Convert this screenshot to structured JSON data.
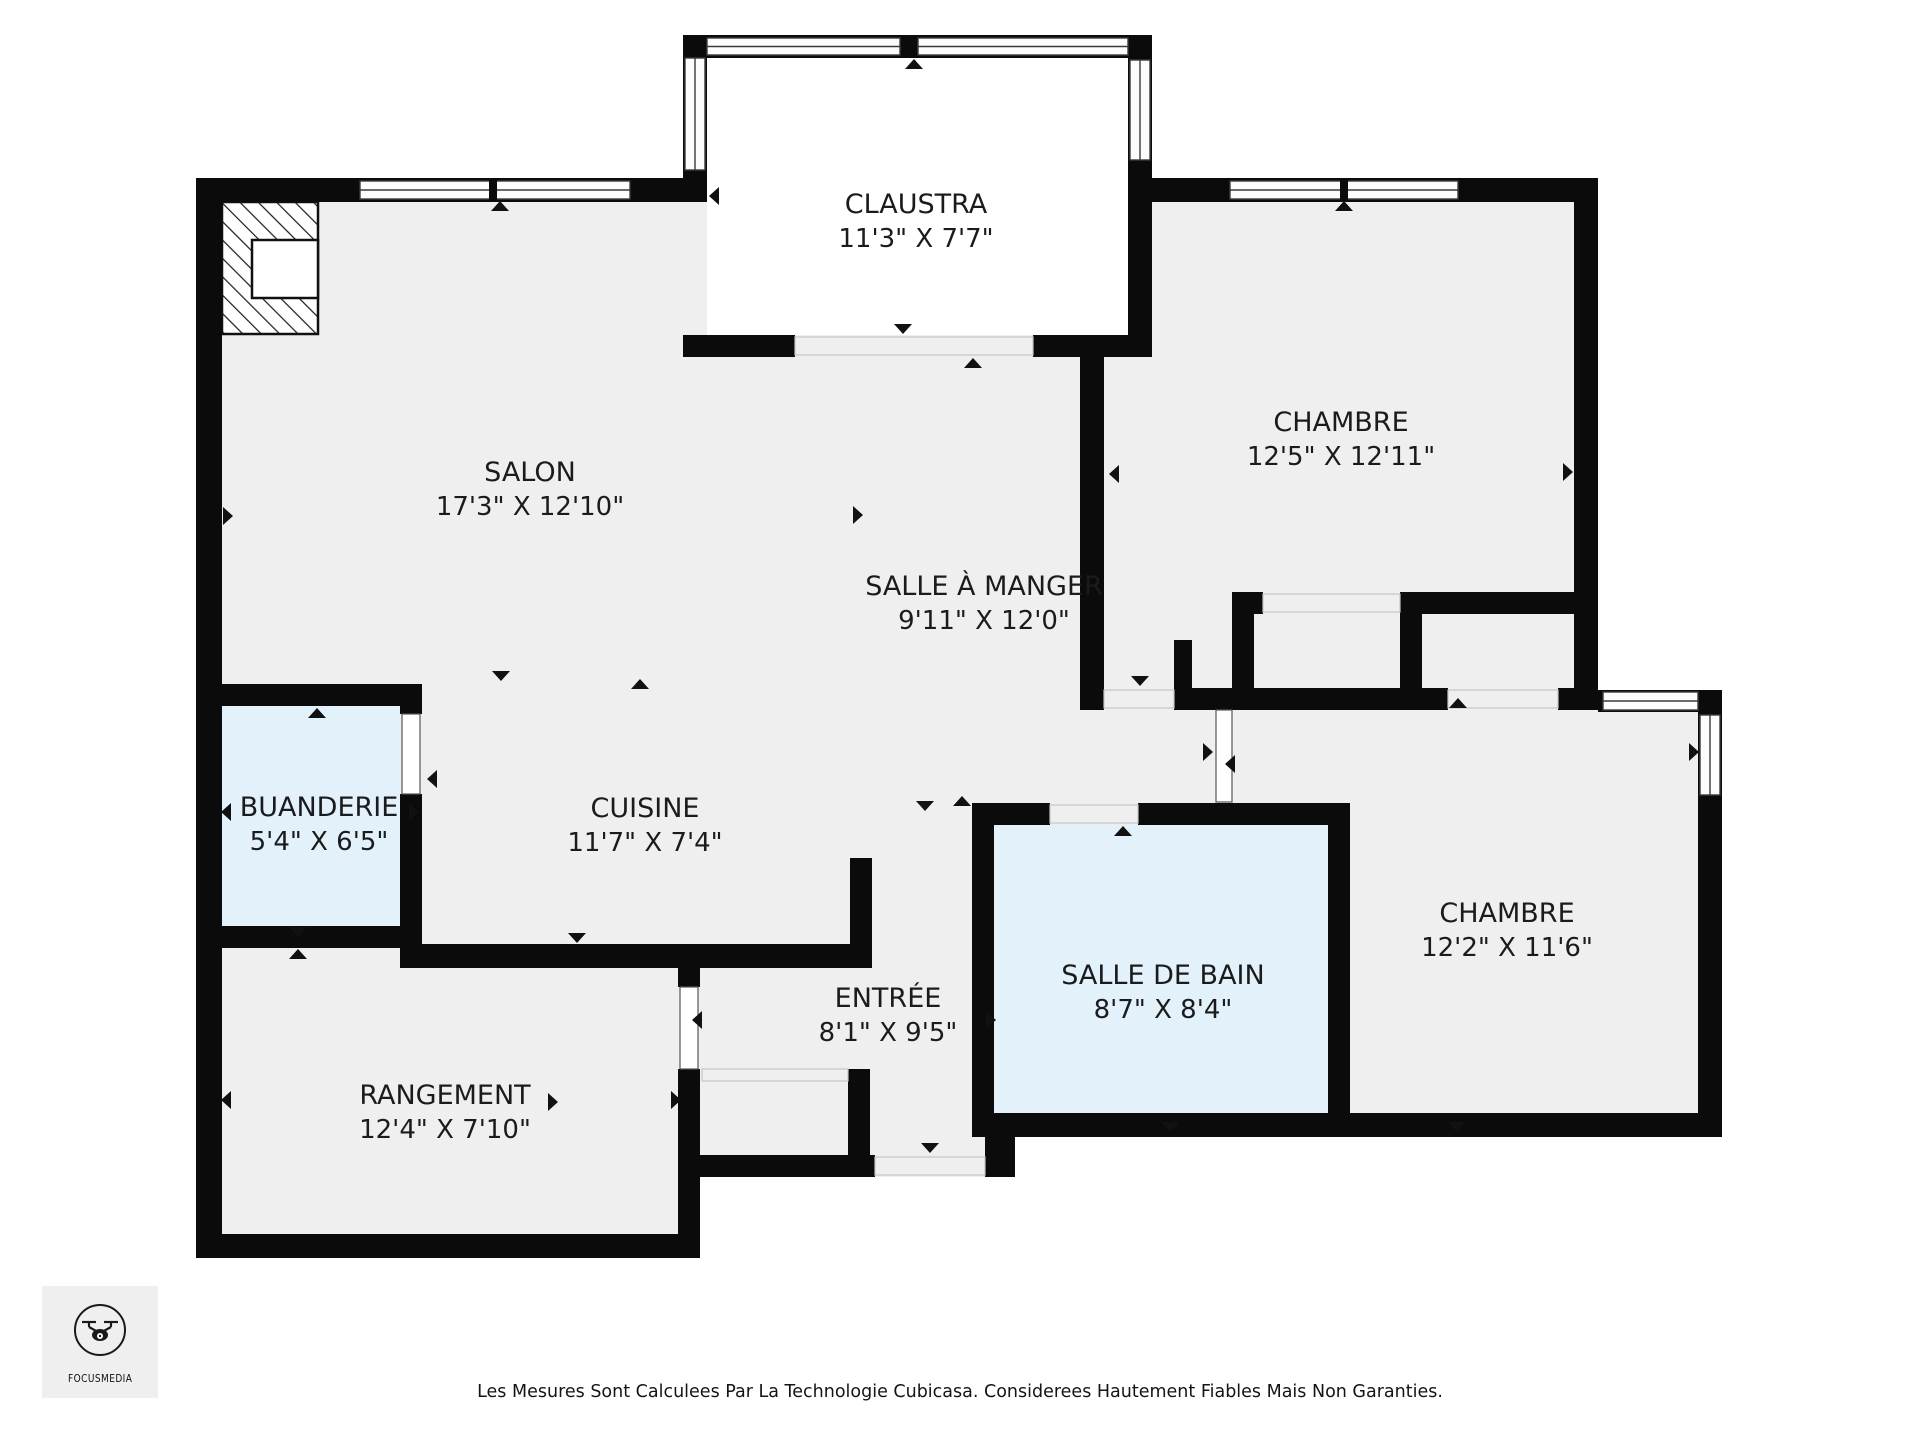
{
  "page": {
    "background": "#ffffff"
  },
  "colors": {
    "wall": "#0b0b0b",
    "floor": "#f0eff0",
    "wet_room": "#e2f1fa",
    "claustra_floor": "#ffffff",
    "window_fill": "#fcfcfc",
    "marker": "#111111",
    "logo_background": "#efefef"
  },
  "rooms": [
    {
      "id": "claustra",
      "name": "CLAUSTRA",
      "dims": "11'3\" X 7'7\""
    },
    {
      "id": "salon",
      "name": "SALON",
      "dims": "17'3\" X 12'10\""
    },
    {
      "id": "chambre-1",
      "name": "CHAMBRE",
      "dims": "12'5\" X 12'11\""
    },
    {
      "id": "salle-a-manger",
      "name": "SALLE À MANGER",
      "dims": "9'11\" X 12'0\""
    },
    {
      "id": "buanderie",
      "name": "BUANDERIE",
      "dims": "5'4\" X 6'5\""
    },
    {
      "id": "cuisine",
      "name": "CUISINE",
      "dims": "11'7\" X 7'4\""
    },
    {
      "id": "chambre-2",
      "name": "CHAMBRE",
      "dims": "12'2\" X 11'6\""
    },
    {
      "id": "salle-de-bain",
      "name": "SALLE DE BAIN",
      "dims": "8'7\" X 8'4\""
    },
    {
      "id": "entree",
      "name": "ENTRÉE",
      "dims": "8'1\" X 9'5\""
    },
    {
      "id": "rangement",
      "name": "RANGEMENT",
      "dims": "12'4\" X 7'10\""
    }
  ],
  "logo": {
    "brand": "FOCUSMEDIA",
    "icon": "drone-icon"
  },
  "footer": {
    "disclaimer": "Les Mesures Sont Calculees Par La Technologie Cubicasa. Considerees Hautement Fiables Mais Non Garanties."
  }
}
